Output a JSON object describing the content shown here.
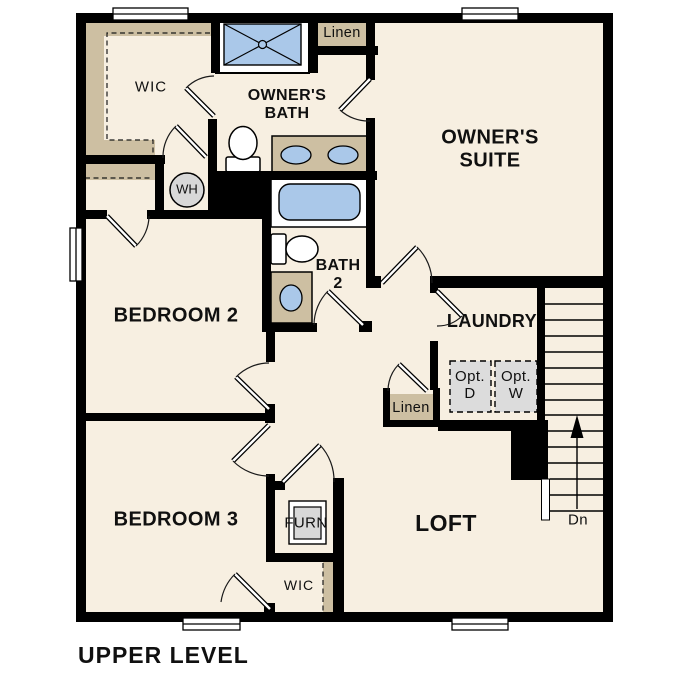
{
  "title": "UPPER LEVEL",
  "labels": {
    "wic_top": "WIC",
    "owners_bath_1": "OWNER'S",
    "owners_bath_2": "BATH",
    "linen_top": "Linen",
    "owners_suite_1": "OWNER'S",
    "owners_suite_2": "SUITE",
    "wh": "WH",
    "bedroom2": "BEDROOM 2",
    "bath2_1": "BATH",
    "bath2_2": "2",
    "laundry": "LAUNDRY",
    "opt_d_1": "Opt.",
    "opt_d_2": "D",
    "opt_w_1": "Opt.",
    "opt_w_2": "W",
    "linen_hall": "Linen",
    "dn": "Dn",
    "bedroom3": "BEDROOM 3",
    "furn": "FURN",
    "wic_bottom": "WIC",
    "loft": "LOFT",
    "title": "UPPER LEVEL"
  },
  "colors": {
    "wall": "#000000",
    "floor": "#f7efe1",
    "cabinetry_tan": "#cdbfa2",
    "fixture_blue": "#aac8e9",
    "appliance_gray": "#d8d8d8",
    "background": "#ffffff"
  }
}
